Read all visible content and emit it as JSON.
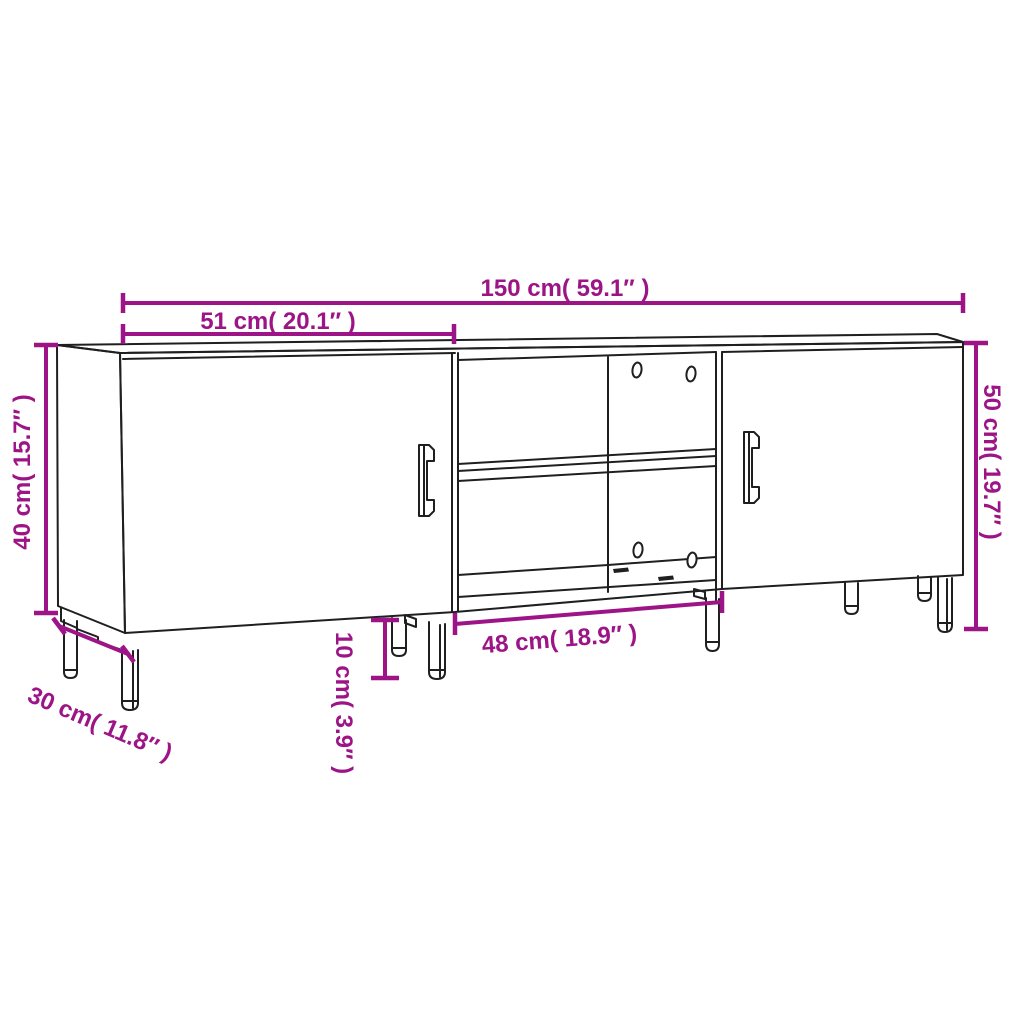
{
  "colors": {
    "dimension": "#9C1486",
    "outline": "#1F1F1F",
    "background": "#FFFFFF"
  },
  "dimensions": {
    "total_width": {
      "label": "150 cm( 59.1″ )",
      "cm": "150",
      "inches": "59.1"
    },
    "left_section_width": {
      "label": "51 cm( 20.1″ )",
      "cm": "51",
      "inches": "20.1"
    },
    "body_height": {
      "label": "40 cm( 15.7″ )",
      "cm": "40",
      "inches": "15.7"
    },
    "total_height": {
      "label": "50 cm( 19.7″ )",
      "cm": "50",
      "inches": "19.7"
    },
    "depth": {
      "label": "30 cm( 11.8″ )",
      "cm": "30",
      "inches": "11.8"
    },
    "leg_height": {
      "label": "10 cm( 3.9″ )",
      "cm": "10",
      "inches": "3.9"
    },
    "middle_section_width": {
      "label": "48 cm( 18.9″ )",
      "cm": "48",
      "inches": "18.9"
    }
  }
}
